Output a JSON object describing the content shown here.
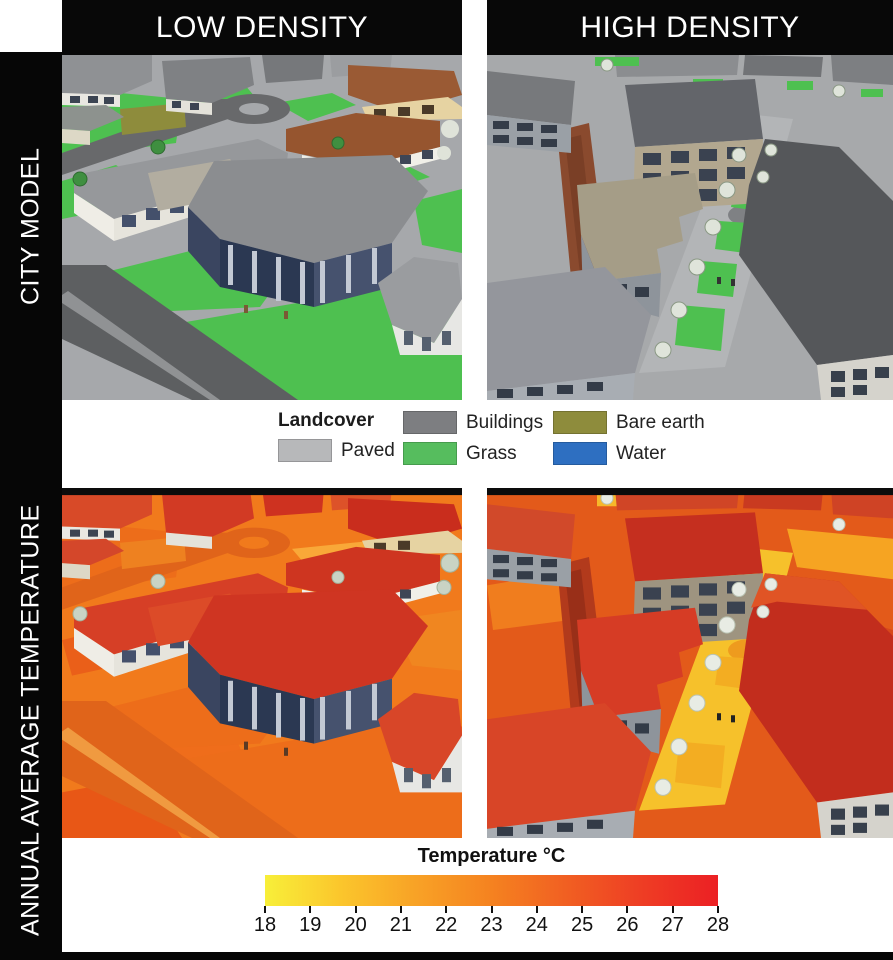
{
  "header": {
    "columns": [
      {
        "label": "LOW DENSITY"
      },
      {
        "label": "HIGH DENSITY"
      }
    ]
  },
  "rows": [
    {
      "label": "CITY MODEL"
    },
    {
      "label": "ANNUAL AVERAGE TEMPERATURE"
    }
  ],
  "legend": {
    "title": "Landcover",
    "items": [
      {
        "label": "Paved",
        "color": "#b7b8ba"
      },
      {
        "label": "Buildings",
        "color": "#7d7e81"
      },
      {
        "label": "Grass",
        "color": "#56bd5e"
      },
      {
        "label": "Bare earth",
        "color": "#8e8c3c"
      },
      {
        "label": "Water",
        "color": "#2e6fc1"
      }
    ]
  },
  "colorbar": {
    "title": "Temperature °C",
    "min": 18,
    "max": 28,
    "ticks": [
      18,
      19,
      20,
      21,
      22,
      23,
      24,
      25,
      26,
      27,
      28
    ],
    "gradient": [
      "#f8ef39",
      "#fbc62c",
      "#f8a226",
      "#f58220",
      "#f15f22",
      "#ee3d24",
      "#ec2024"
    ]
  },
  "colors": {
    "frame": "#060606",
    "background": "#ffffff"
  },
  "panels": [
    {
      "id": "city-model-low-density"
    },
    {
      "id": "city-model-high-density"
    },
    {
      "id": "annual-average-temperature-low-density"
    },
    {
      "id": "annual-average-temperature-high-density"
    }
  ]
}
